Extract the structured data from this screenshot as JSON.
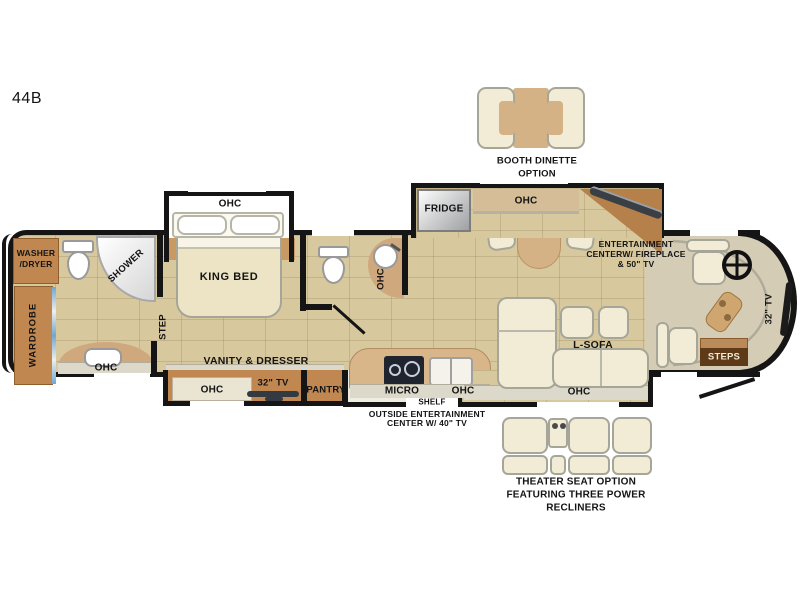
{
  "plan": {
    "model": "44B"
  },
  "labels": {
    "ohc": "OHC",
    "fridge": "FRIDGE",
    "king_bed": "KING BED",
    "shower": "SHOWER",
    "washer_line1": "WASHER",
    "washer_line2": "/DRYER",
    "wardrobe": "WARDROBE",
    "step": "STEP",
    "vanity_dresser": "VANITY & DRESSER",
    "tv_32": "32\" TV",
    "pantry": "PANTRY",
    "micro": "MICRO",
    "shelf": "SHELF",
    "l_sofa": "L-SOFA",
    "steps": "STEPS"
  },
  "annotations": {
    "booth_dinette": {
      "line1": "BOOTH DINETTE",
      "line2": "OPTION"
    },
    "entertainment_center": {
      "line1": "ENTERTAINMENT",
      "line2": "CENTERW/ FIREPLACE",
      "line3": "& 50\" TV"
    },
    "outside_entertainment": {
      "line1": "OUTSIDE ENTERTAINMENT",
      "line2": "CENTER W/ 40\" TV"
    },
    "theater_seat": {
      "line1": "THEATER SEAT OPTION",
      "line2": "FEATURING THREE POWER",
      "line3": "RECLINERS"
    }
  },
  "colors": {
    "floor": "#d8c89e",
    "cabinet": "#c08850",
    "counter_tan": "#cfa87e",
    "furniture_cream": "#f2ecd6",
    "wall": "#151515",
    "accent_blue": "#6fa8d4",
    "tv_dark": "#343a41"
  }
}
